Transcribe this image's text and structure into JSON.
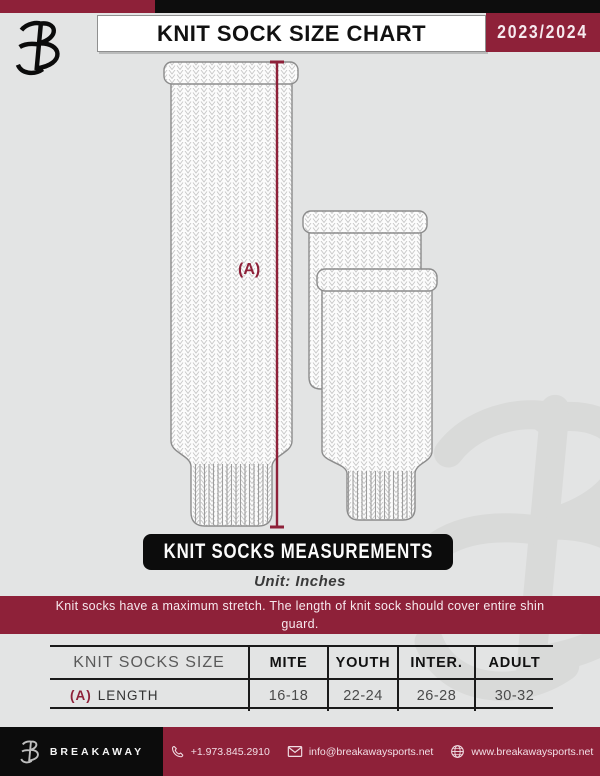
{
  "header": {
    "title": "KNIT SOCK SIZE CHART",
    "season": "2023/2024"
  },
  "diagram": {
    "measure_label": "(A)"
  },
  "section": {
    "banner": "KNIT SOCKS MEASUREMENTS",
    "unit": "Unit: Inches",
    "note": "Knit socks have a maximum stretch. The length of knit sock should cover entire shin guard."
  },
  "table": {
    "size_header": "KNIT SOCKS SIZE",
    "columns": [
      "MITE",
      "YOUTH",
      "INTER.",
      "ADULT"
    ],
    "rows": [
      {
        "prefix": "(A)",
        "label": "LENGTH",
        "values": [
          "16-18",
          "22-24",
          "26-28",
          "30-32"
        ]
      }
    ]
  },
  "footer": {
    "brand": "BREAKAWAY",
    "phone": "+1.973.845.2910",
    "email": "info@breakawaysports.net",
    "website": "www.breakawaysports.net"
  },
  "colors": {
    "accent": "#8e2139",
    "background": "#e3e4e4",
    "banner_black": "#0c0c0c"
  }
}
